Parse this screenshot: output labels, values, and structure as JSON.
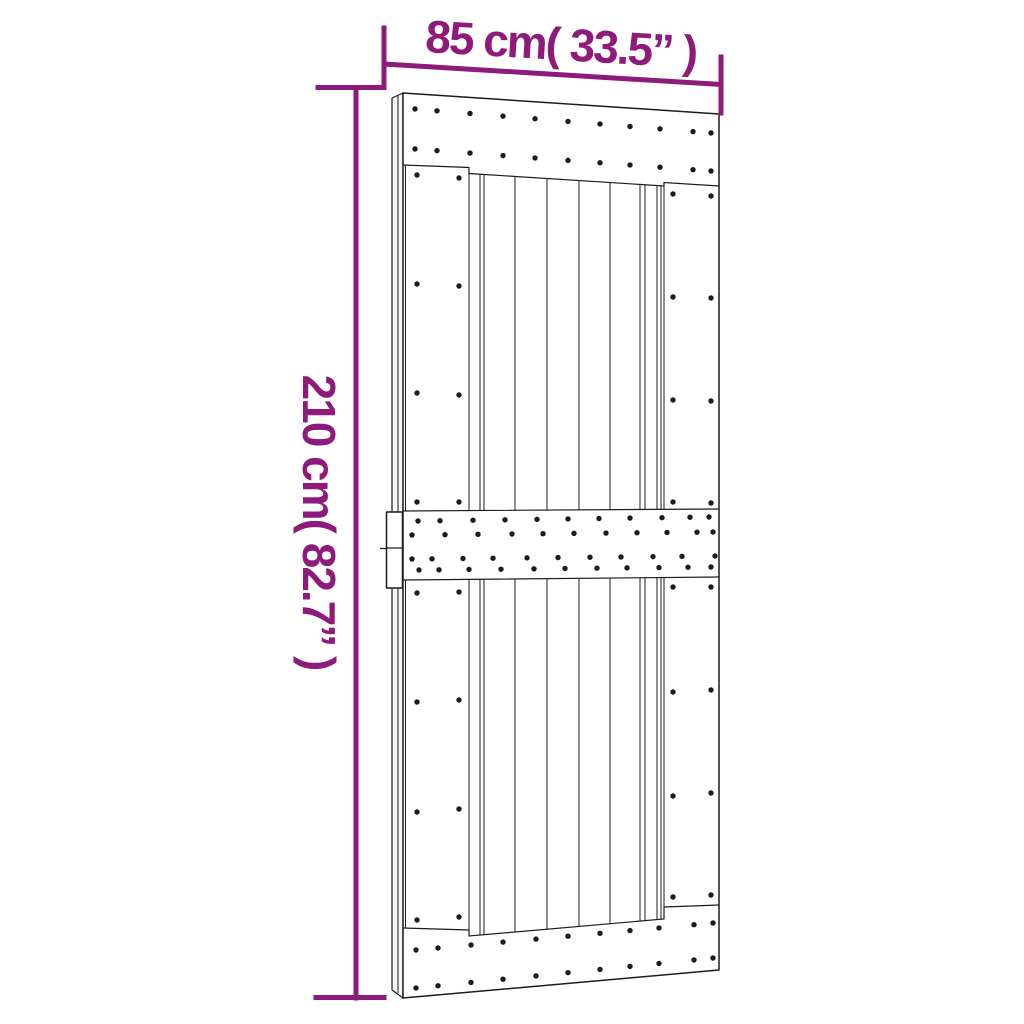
{
  "page": {
    "background": "#ffffff"
  },
  "dimension_labels": {
    "width": "85 cm( 33.5” )",
    "height": "210 cm( 82.7” )"
  },
  "measurements": {
    "width_cm": "85",
    "width_in": "33.5",
    "height_cm": "210",
    "height_in": "82.7"
  },
  "style": {
    "dimension_color": "#8e1a7b",
    "line_color": "#1c1c1c",
    "door_fill": "#ffffff",
    "side_fill": "#f6f6f6"
  },
  "figure": {
    "type": "product-dimension-diagram",
    "subject": "plank barn door with three nailed cross rails, side pull handle, slight left perspective",
    "plank_lines_x": [
      405.5,
      469,
      480,
      484,
      515,
      547,
      579,
      610,
      640,
      645,
      657,
      661,
      664
    ],
    "edges": {
      "top_rail_bottom": [
        [
          403,
          165
        ],
        [
          469,
          167.5
        ],
        [
          469,
          173.5
        ],
        [
          664,
          186
        ],
        [
          664,
          182.5
        ],
        [
          719,
          186
        ]
      ],
      "mid_rail_top": [
        [
          403,
          511
        ],
        [
          719,
          509
        ]
      ],
      "mid_rail_bottom": [
        [
          403,
          580
        ],
        [
          719,
          577
        ]
      ],
      "bottom_rail_top": [
        [
          403,
          928
        ],
        [
          469,
          930
        ],
        [
          469,
          936
        ],
        [
          664,
          919
        ],
        [
          664,
          907
        ],
        [
          719,
          905
        ]
      ]
    },
    "nails": {
      "rail_rows": [
        {
          "xs": [
            415,
            437,
            470,
            503,
            535,
            568,
            600,
            630,
            660,
            693,
            711
          ],
          "y0": 109,
          "y1": 133
        },
        {
          "xs": [
            415,
            437,
            470,
            503,
            535,
            568,
            600,
            630,
            660,
            693,
            711
          ],
          "y0": 149,
          "y1": 171
        },
        {
          "xs": [
            418,
            440,
            473,
            505,
            537,
            568,
            599,
            630,
            662,
            690,
            709
          ],
          "y0": 521,
          "y1": 517
        },
        {
          "xs": [
            412,
            445,
            478,
            512,
            543,
            574,
            606,
            637,
            667,
            697,
            713
          ],
          "y0": 535,
          "y1": 532
        },
        {
          "xs": [
            412,
            432,
            463,
            493,
            527,
            558,
            590,
            621,
            653,
            682,
            715
          ],
          "y0": 559,
          "y1": 556
        },
        {
          "xs": [
            419,
            439,
            469,
            501,
            534,
            565,
            597,
            627,
            659,
            688,
            711
          ],
          "y0": 570,
          "y1": 567
        },
        {
          "xs": [
            416,
            438,
            471,
            503,
            536,
            568,
            600,
            630,
            659,
            694,
            713
          ],
          "y0": 950,
          "y1": 923
        },
        {
          "xs": [
            416,
            438,
            471,
            503,
            536,
            568,
            600,
            630,
            659,
            694,
            713
          ],
          "y0": 988,
          "y1": 958
        }
      ],
      "stile_pairs": [
        {
          "xs": [
            417,
            459
          ],
          "rows": [
            [
              175,
              178
            ],
            [
              284,
              286
            ],
            [
              393,
              395
            ],
            [
              502,
              502
            ],
            [
              593,
              592
            ],
            [
              702,
              700
            ],
            [
              812,
              809
            ],
            [
              920,
              917
            ]
          ]
        },
        {
          "xs": [
            673,
            711
          ],
          "rows": [
            [
              194,
              196
            ],
            [
              297,
              298
            ],
            [
              400,
              401
            ],
            [
              502,
              503
            ],
            [
              587,
              587
            ],
            [
              692,
              690
            ],
            [
              796,
              793
            ],
            [
              897,
              895
            ]
          ]
        }
      ]
    }
  }
}
